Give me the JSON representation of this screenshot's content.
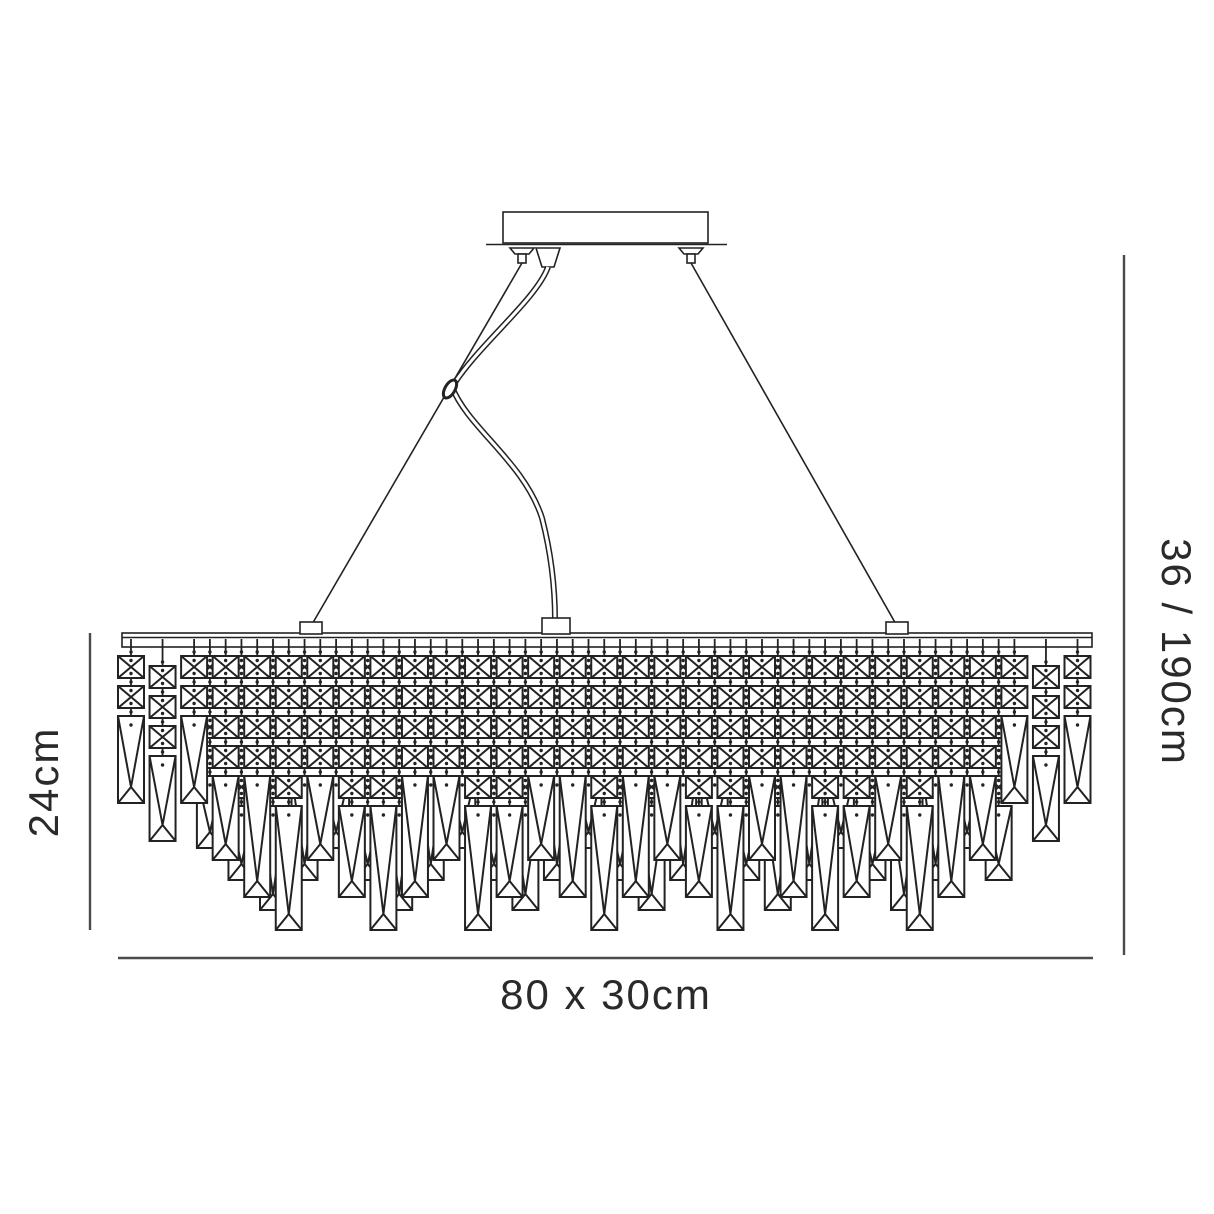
{
  "diagram_title": "Linear crystal chandelier dimension drawing",
  "dimensions": {
    "body_height_label": "24cm",
    "total_height_label": "36 / 190cm",
    "width_depth_label": "80 x 30cm"
  },
  "colors": {
    "line": "#222222",
    "dim_line": "#4a4a4a",
    "text": "#2a2a2a",
    "background": "#ffffff"
  },
  "chandelier": {
    "rail": {
      "x1": 122,
      "x2": 1092,
      "y": 633,
      "h": 14
    },
    "crystal_top": 656,
    "square": {
      "w": 26,
      "h": 22,
      "pitch": 30
    },
    "front_row": {
      "start_x": 131,
      "pitch": 31.55,
      "strands": [
        {
          "squares": 2,
          "bottom": 803
        },
        {
          "squares": 3,
          "bottom": 841,
          "dy": 10
        },
        {
          "squares": 2,
          "bottom": 803
        },
        {
          "squares": 4,
          "bottom": 860
        },
        {
          "squares": 4,
          "bottom": 897
        },
        {
          "squares": 5,
          "bottom": 930
        },
        {
          "squares": 4,
          "bottom": 860
        },
        {
          "squares": 5,
          "bottom": 897
        },
        {
          "squares": 5,
          "bottom": 930
        },
        {
          "squares": 4,
          "bottom": 897
        },
        {
          "squares": 4,
          "bottom": 860
        },
        {
          "squares": 5,
          "bottom": 930
        },
        {
          "squares": 5,
          "bottom": 897
        },
        {
          "squares": 4,
          "bottom": 860
        },
        {
          "squares": 4,
          "bottom": 897
        },
        {
          "squares": 5,
          "bottom": 930
        },
        {
          "squares": 4,
          "bottom": 897
        },
        {
          "squares": 4,
          "bottom": 860
        },
        {
          "squares": 5,
          "bottom": 897
        },
        {
          "squares": 5,
          "bottom": 930
        },
        {
          "squares": 4,
          "bottom": 860
        },
        {
          "squares": 4,
          "bottom": 897
        },
        {
          "squares": 5,
          "bottom": 930
        },
        {
          "squares": 5,
          "bottom": 897
        },
        {
          "squares": 4,
          "bottom": 860
        },
        {
          "squares": 5,
          "bottom": 930
        },
        {
          "squares": 4,
          "bottom": 897
        },
        {
          "squares": 4,
          "bottom": 860
        },
        {
          "squares": 2,
          "bottom": 803
        },
        {
          "squares": 3,
          "bottom": 841,
          "dy": 10
        },
        {
          "squares": 2,
          "bottom": 803
        }
      ]
    },
    "back_row": {
      "start_x": 209.9,
      "pitch": 31.55,
      "strands": [
        {
          "squares": 4,
          "bottom": 848
        },
        {
          "squares": 5,
          "bottom": 880
        },
        {
          "squares": 5,
          "bottom": 910
        },
        {
          "squares": 4,
          "bottom": 880
        },
        {
          "squares": 4,
          "bottom": 848
        },
        {
          "squares": 5,
          "bottom": 880
        },
        {
          "squares": 5,
          "bottom": 910
        },
        {
          "squares": 4,
          "bottom": 880
        },
        {
          "squares": 4,
          "bottom": 848
        },
        {
          "squares": 5,
          "bottom": 880
        },
        {
          "squares": 5,
          "bottom": 910
        },
        {
          "squares": 4,
          "bottom": 880
        },
        {
          "squares": 4,
          "bottom": 848
        },
        {
          "squares": 5,
          "bottom": 880
        },
        {
          "squares": 5,
          "bottom": 910
        },
        {
          "squares": 4,
          "bottom": 880
        },
        {
          "squares": 4,
          "bottom": 848
        },
        {
          "squares": 5,
          "bottom": 880
        },
        {
          "squares": 5,
          "bottom": 910
        },
        {
          "squares": 4,
          "bottom": 880
        },
        {
          "squares": 4,
          "bottom": 848
        },
        {
          "squares": 5,
          "bottom": 880
        },
        {
          "squares": 5,
          "bottom": 910
        },
        {
          "squares": 4,
          "bottom": 880
        },
        {
          "squares": 4,
          "bottom": 848
        },
        {
          "squares": 5,
          "bottom": 880
        }
      ]
    }
  }
}
